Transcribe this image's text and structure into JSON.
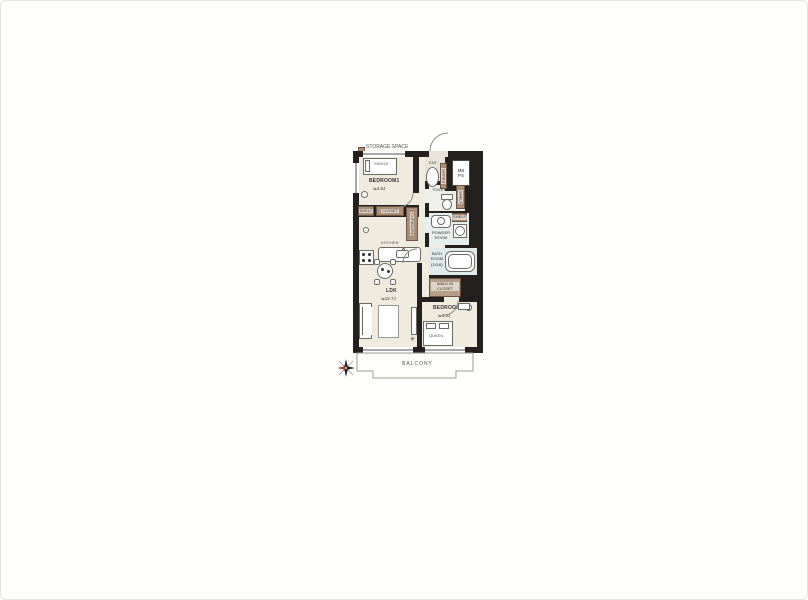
{
  "legend": {
    "storage_space": "STORAGE SPACE"
  },
  "rooms": {
    "bedroom1": {
      "label": "BEDROOM1",
      "size": "≒4.5J"
    },
    "ldk": {
      "label": "LDK",
      "size": "≒12.7J"
    },
    "bedroom2": {
      "label": "BEDROOM2",
      "size": "≒5.0J"
    },
    "toilet": {
      "label": "TOILET"
    },
    "powder": {
      "label": "POWDER ROOM"
    },
    "bath": {
      "label": "BATH ROOM",
      "size": "(1416)"
    },
    "wic": {
      "label": "WALK IN CLOSET"
    },
    "entrance": {
      "label": "ENT"
    },
    "balcony": {
      "label": "BALCONY"
    }
  },
  "service": {
    "meter_box": "MB",
    "pipe_space": "PS"
  },
  "furniture": {
    "single_bed": "SINGLE",
    "queen_bed": "QUEEN",
    "bedroom1_shelf": "SHELF",
    "bedroom1_closet": "CLOSET",
    "cupboard": "CUPBOARD",
    "shoes_box": "SHOES",
    "toilet_shelf": "SHELF",
    "powder_shelf": "SHELF",
    "kitchen": "KITCHEN"
  },
  "icons": {
    "plant": "✳",
    "compass": "north-compass"
  },
  "colors": {
    "wall": "#23201d",
    "floor": "#f0ebdf",
    "wet_toilet": "#edf1ea",
    "wet_powder": "#e6efec",
    "wet_bath": "#dfeaeb",
    "ent": "#e7e3da",
    "storage": "#ab8e76",
    "storage_dark": "#6d5341",
    "wic": "#b79d87",
    "outline": "#6b6b64",
    "balcony_line": "#9a9a94",
    "north_red": "#c03a2b"
  }
}
